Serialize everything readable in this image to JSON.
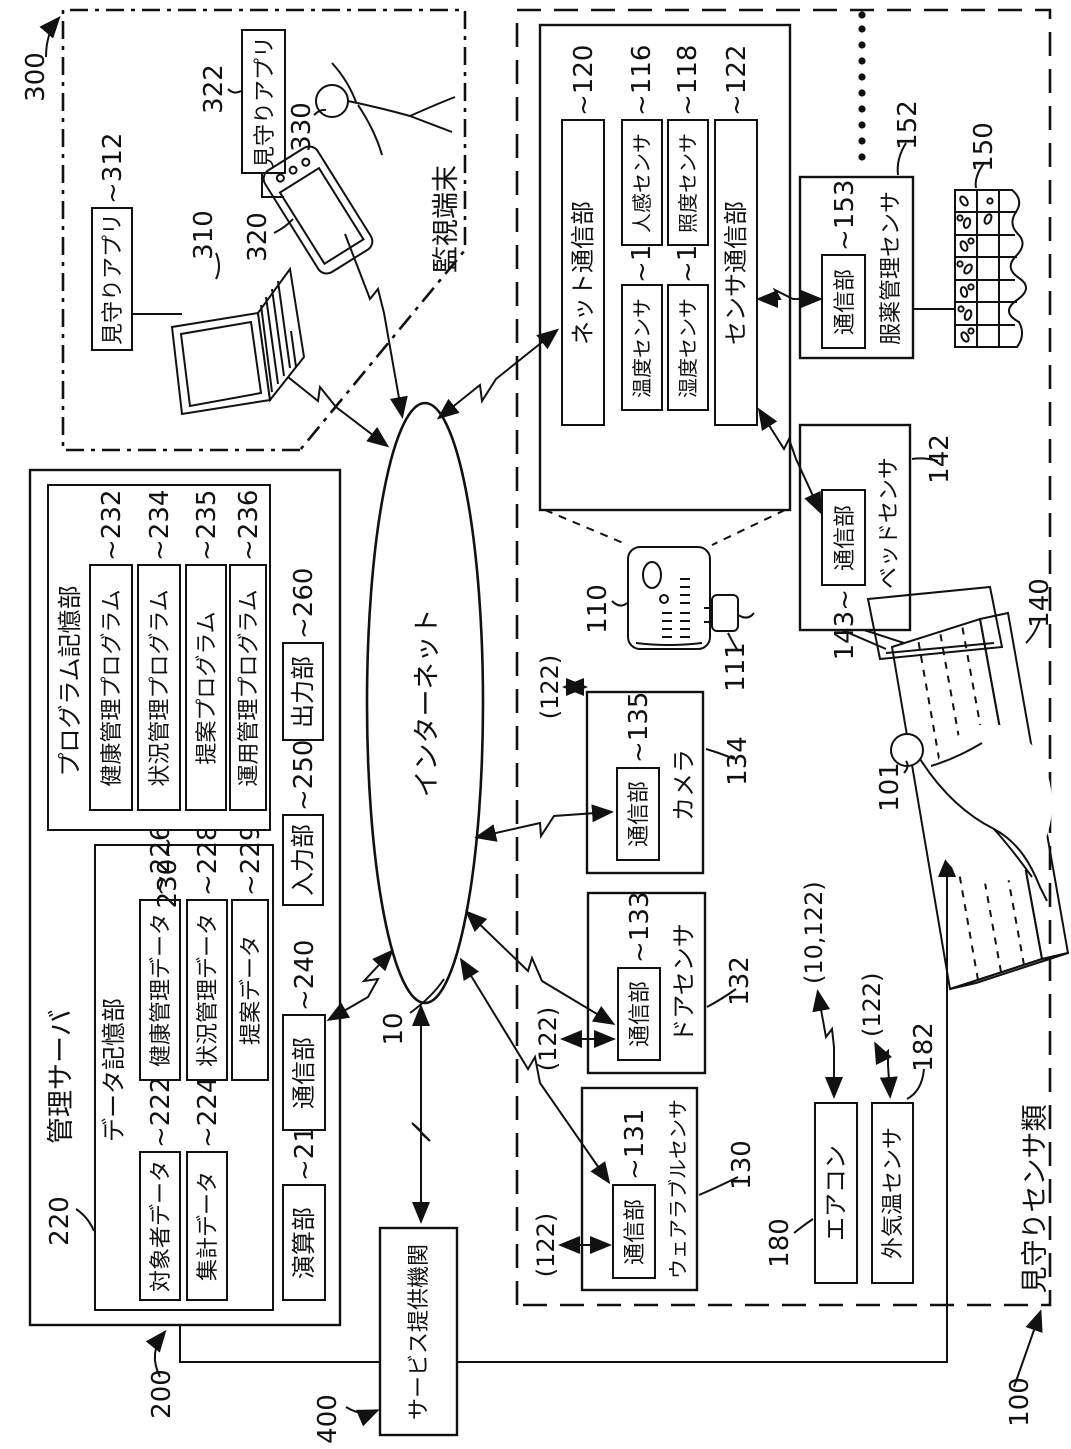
{
  "figure": {
    "colors": {
      "ink": "#111111",
      "background": "#ffffff"
    },
    "internet": {
      "label": "インターネット",
      "ref": "10"
    },
    "service_provider": {
      "label": "サービス提供機関",
      "ref": "400"
    },
    "management_server": {
      "ref": "200",
      "title": "管理サーバ",
      "data_storage": {
        "ref": "220",
        "title": "データ記憶部",
        "items": [
          {
            "label": "対象者データ",
            "ref": "~222"
          },
          {
            "label": "集計データ",
            "ref": "~224"
          },
          {
            "label": "健康管理データ",
            "ref": "~226"
          },
          {
            "label": "状況管理データ",
            "ref": "~228"
          },
          {
            "label": "提案データ",
            "ref": "~229"
          }
        ]
      },
      "program_storage": {
        "ref": "230~",
        "title": "プログラム記憶部",
        "items": [
          {
            "label": "健康管理プログラム",
            "ref": "~232"
          },
          {
            "label": "状況管理プログラム",
            "ref": "~234"
          },
          {
            "label": "提案プログラム",
            "ref": "~235"
          },
          {
            "label": "運用管理プログラム",
            "ref": "~236"
          }
        ]
      },
      "units": [
        {
          "label": "演算部",
          "ref": "~210"
        },
        {
          "label": "通信部",
          "ref": "~240"
        },
        {
          "label": "入力部",
          "ref": "~250"
        },
        {
          "label": "出力部",
          "ref": "~260"
        }
      ]
    },
    "monitoring_terminal": {
      "ref": "300",
      "title": "監視端末",
      "pc_app": {
        "label": "見守りアプリ",
        "ref": "~312"
      },
      "pc_ref": "310",
      "phone_app": {
        "label": "見守りアプリ",
        "ref": "322"
      },
      "phone_ref": "320",
      "person_ref": "330"
    },
    "watch_sensors": {
      "ref": "100",
      "title": "見守りセンサ類",
      "hub": {
        "ref": "110",
        "plug_ref": "111",
        "net_comm": {
          "label": "ネット通信部",
          "ref": "~120"
        },
        "temp": {
          "label": "温度センサ",
          "ref": "~112"
        },
        "humid": {
          "label": "湿度センサ",
          "ref": "~114"
        },
        "motion": {
          "label": "人感センサ",
          "ref": "~116"
        },
        "illum": {
          "label": "照度センサ",
          "ref": "~118"
        },
        "sensor_comm": {
          "label": "センサ通信部",
          "ref": "~122"
        }
      },
      "medication": {
        "label": "服薬管理センサ",
        "ref": "152",
        "comm": {
          "label": "通信部",
          "ref": "~153"
        },
        "pillbox_ref": "150"
      },
      "bed_sensor": {
        "label": "ベッドセンサ",
        "ref": "142",
        "comm": {
          "label": "通信部",
          "ref": "143~"
        },
        "bed_ref": "140",
        "person_ref": "101"
      },
      "camera": {
        "label": "カメラ",
        "ref": "134",
        "comm": {
          "label": "通信部",
          "ref": "~135"
        }
      },
      "door": {
        "label": "ドアセンサ",
        "ref": "132",
        "comm": {
          "label": "通信部",
          "ref": "~133"
        }
      },
      "wearable": {
        "label": "ウェアラブルセンサ",
        "ref": "130",
        "comm": {
          "label": "通信部",
          "ref": "~131"
        }
      },
      "aircon": {
        "label": "エアコン",
        "ref": "180"
      },
      "outdoor_temp": {
        "label": "外気温センサ",
        "ref": "182"
      },
      "links": {
        "l122": "(122)",
        "l10_122": "(10,122)"
      }
    }
  }
}
